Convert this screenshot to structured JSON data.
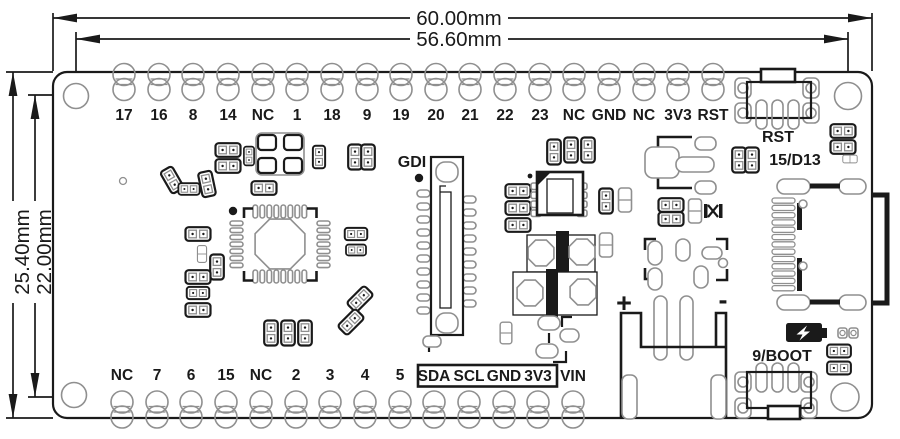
{
  "drawing": {
    "title": "PCB mechanical dimension drawing",
    "dimensions": {
      "width_outer": "60.00mm",
      "width_inner": "56.60mm",
      "height_outer": "25.40mm",
      "height_inner": "22.00mm"
    },
    "top_pins": [
      "17",
      "16",
      "8",
      "14",
      "NC",
      "1",
      "18",
      "9",
      "19",
      "20",
      "21",
      "22",
      "23",
      "NC",
      "GND",
      "NC",
      "3V3",
      "RST"
    ],
    "bottom_pins": [
      "NC",
      "7",
      "6",
      "15",
      "NC",
      "2",
      "3",
      "4",
      "5"
    ],
    "bottom_boxed_pins": [
      "SDA",
      "SCL",
      "GND",
      "3V3"
    ],
    "bottom_last_pin": "VIN",
    "labels": {
      "gdi": "GDI",
      "reset_button": "RST",
      "d13": "15/D13",
      "boot_button": "9/BOOT",
      "battery_plus": "+",
      "battery_minus": "-"
    },
    "icons": {
      "battery_charging": "battery-charging-icon"
    },
    "colors": {
      "line": "#1a1a1a",
      "pad": "#8f8f8f",
      "background": "#ffffff"
    }
  }
}
